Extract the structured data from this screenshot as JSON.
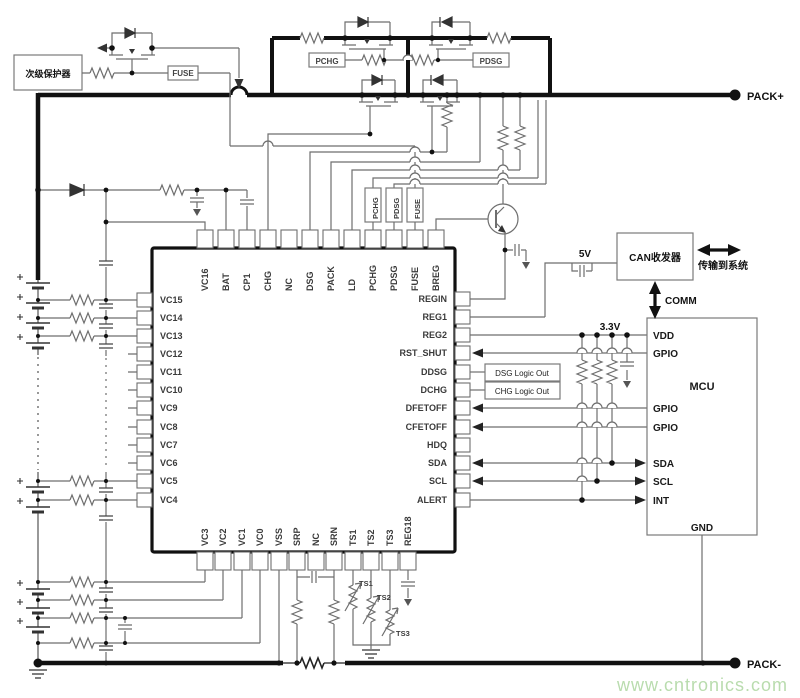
{
  "colors": {
    "background": "#ffffff",
    "wire": "#6e6e6e",
    "rail": "#111111",
    "watermark": "#b9dcae"
  },
  "terminals": {
    "pack_plus": "PACK+",
    "pack_minus": "PACK-"
  },
  "protection": {
    "secondary_protector": "次级保护器",
    "fuse": "FUSE"
  },
  "fets": {
    "pchg_label": "PCHG",
    "pdsg_label": "PDSG"
  },
  "nets": {
    "pchg": "PCHG",
    "pdsg": "PDSG",
    "fuse": "FUSE"
  },
  "ic": {
    "pins_top": [
      "VC16",
      "BAT",
      "CP1",
      "CHG",
      "NC",
      "DSG",
      "PACK",
      "LD",
      "PCHG",
      "PDSG",
      "FUSE",
      "BREG"
    ],
    "pins_left": [
      "VC15",
      "VC14",
      "VC13",
      "VC12",
      "VC11",
      "VC10",
      "VC9",
      "VC8",
      "VC7",
      "VC6",
      "VC5",
      "VC4"
    ],
    "pins_right": [
      "REGIN",
      "REG1",
      "REG2",
      "RST_SHUT",
      "DDSG",
      "DCHG",
      "DFETOFF",
      "CFETOFF",
      "HDQ",
      "SDA",
      "SCL",
      "ALERT"
    ],
    "pins_bottom": [
      "VC3",
      "VC2",
      "VC1",
      "VC0",
      "VSS",
      "SRP",
      "NC",
      "SRN",
      "TS1",
      "TS2",
      "TS3",
      "REG18"
    ]
  },
  "logic_outputs": {
    "dsg": "DSG Logic Out",
    "chg": "CHG Logic Out"
  },
  "rails": {
    "v5": "5V",
    "v33": "3.3V"
  },
  "comm": {
    "label": "COMM",
    "can_transceiver": "CAN收发器",
    "to_system": "传输到系统"
  },
  "mcu": {
    "label": "MCU",
    "pins_left": [
      "VDD",
      "GPIO",
      "GPIO",
      "GPIO",
      "SDA",
      "SCL",
      "INT"
    ],
    "pin_bottom": "GND"
  },
  "thermistors": [
    "TS1",
    "TS2",
    "TS3"
  ],
  "watermark": "www.cntronics.com"
}
